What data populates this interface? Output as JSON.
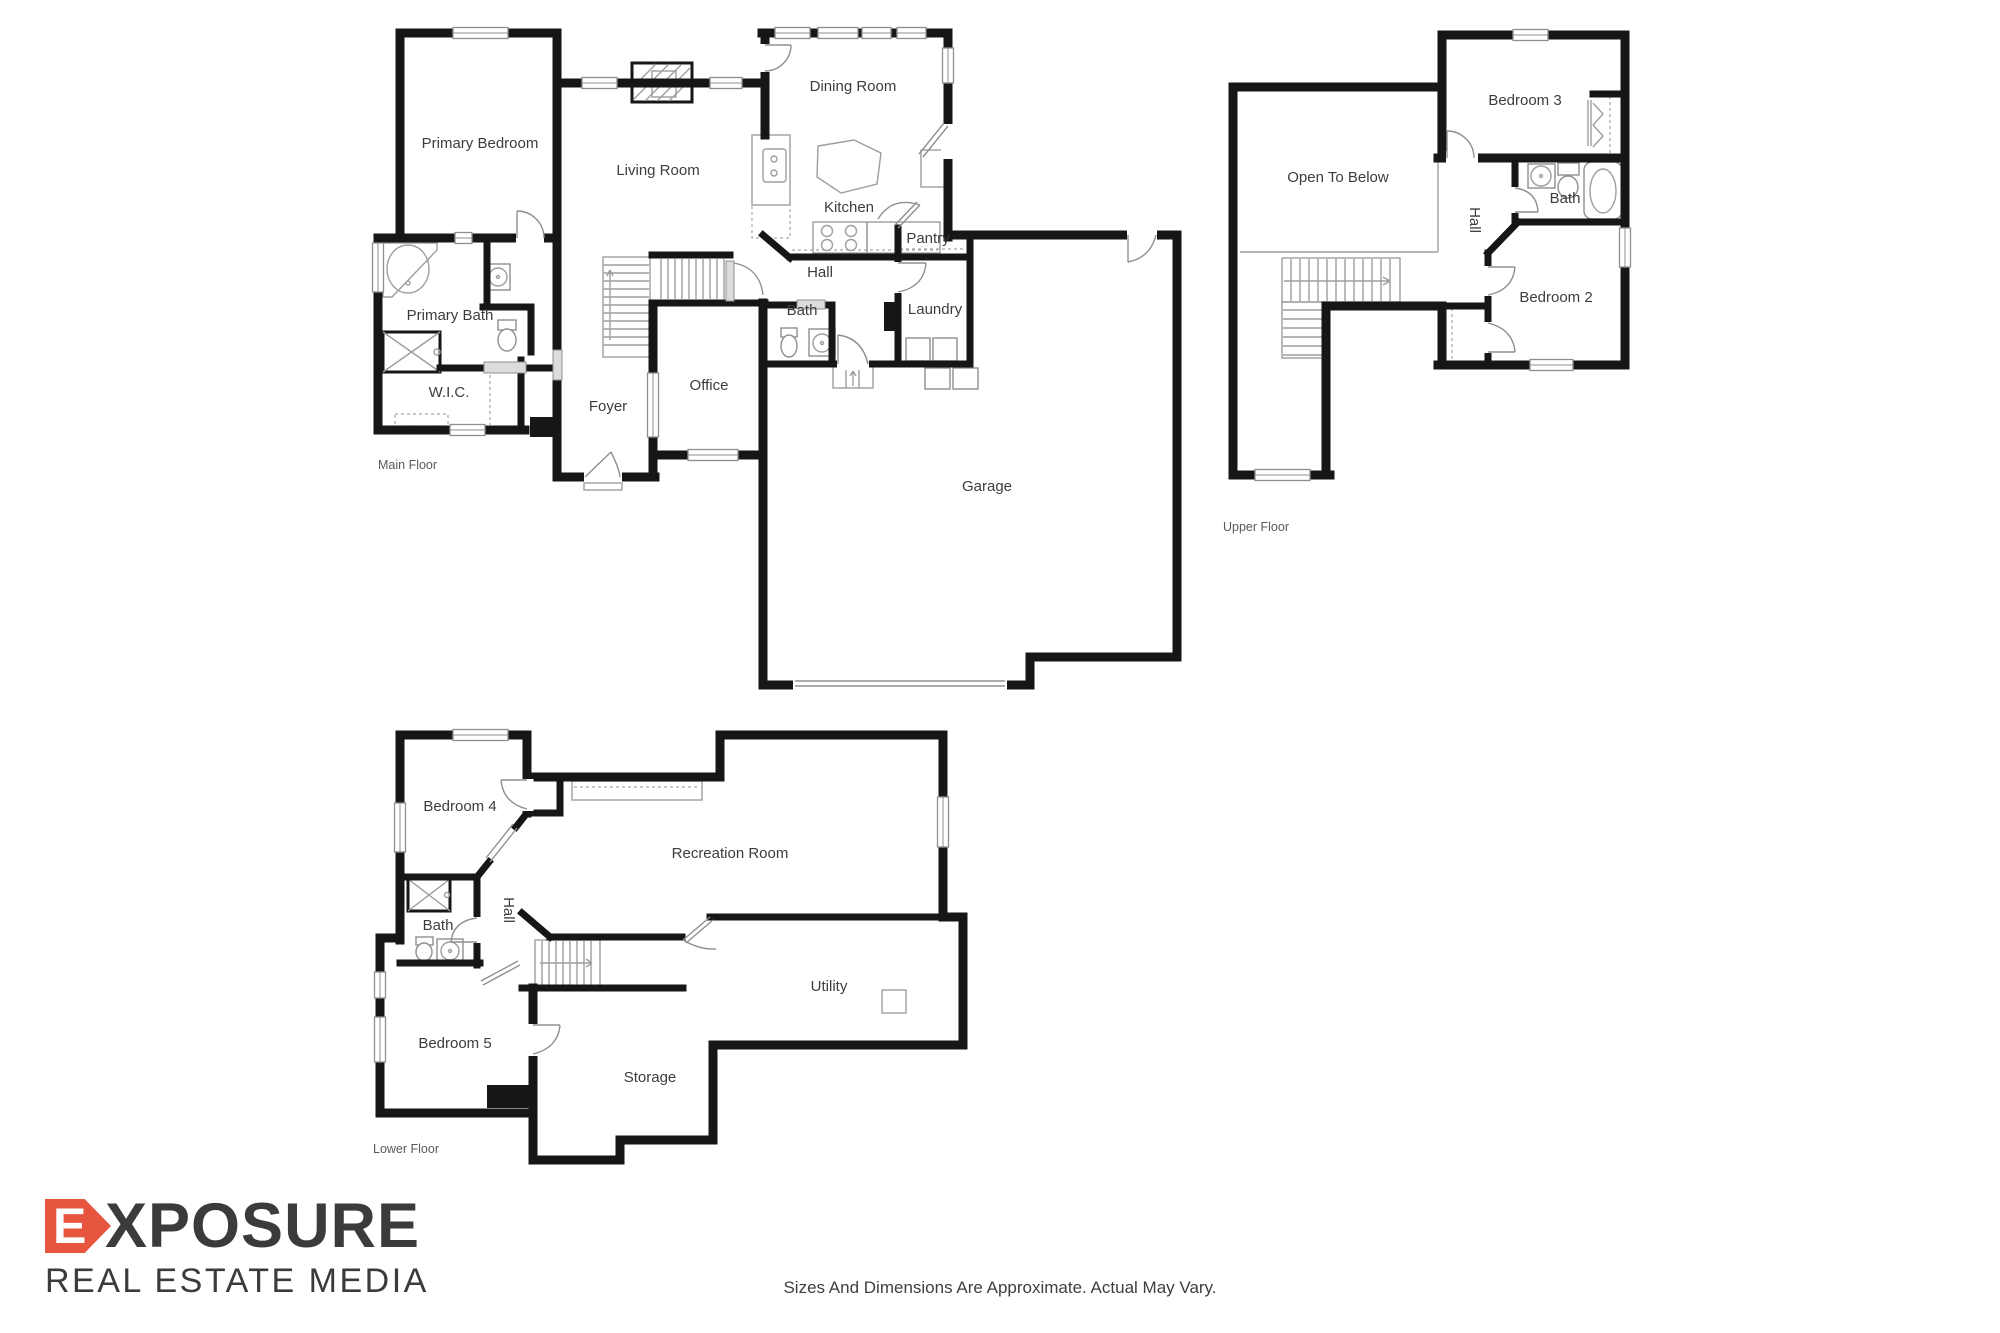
{
  "colors": {
    "wall": "#161616",
    "thin_line": "#9e9e9e",
    "logo_accent": "#e8553f",
    "logo_text": "#3b3b3d",
    "label_text": "#3d3d3d"
  },
  "floors": {
    "main": {
      "label": "Main Floor",
      "rooms": {
        "primary_bedroom": "Primary Bedroom",
        "living_room": "Living Room",
        "dining_room": "Dining Room",
        "kitchen": "Kitchen",
        "pantry": "Pantry",
        "hall": "Hall",
        "laundry": "Laundry",
        "bath": "Bath",
        "primary_bath": "Primary Bath",
        "wic": "W.I.C.",
        "foyer": "Foyer",
        "office": "Office",
        "garage": "Garage"
      }
    },
    "upper": {
      "label": "Upper Floor",
      "rooms": {
        "open_to_below": "Open To Below",
        "bedroom3": "Bedroom 3",
        "bath": "Bath",
        "hall": "Hall",
        "bedroom2": "Bedroom 2"
      }
    },
    "lower": {
      "label": "Lower Floor",
      "rooms": {
        "bedroom4": "Bedroom 4",
        "recreation_room": "Recreation Room",
        "bath": "Bath",
        "hall": "Hall",
        "utility": "Utility",
        "bedroom5": "Bedroom 5",
        "storage": "Storage"
      }
    }
  },
  "logo": {
    "brand_first_letter": "E",
    "brand_rest": "XPOSURE",
    "subtitle": "REAL ESTATE MEDIA"
  },
  "disclaimer": "Sizes And Dimensions Are Approximate. Actual May Vary."
}
